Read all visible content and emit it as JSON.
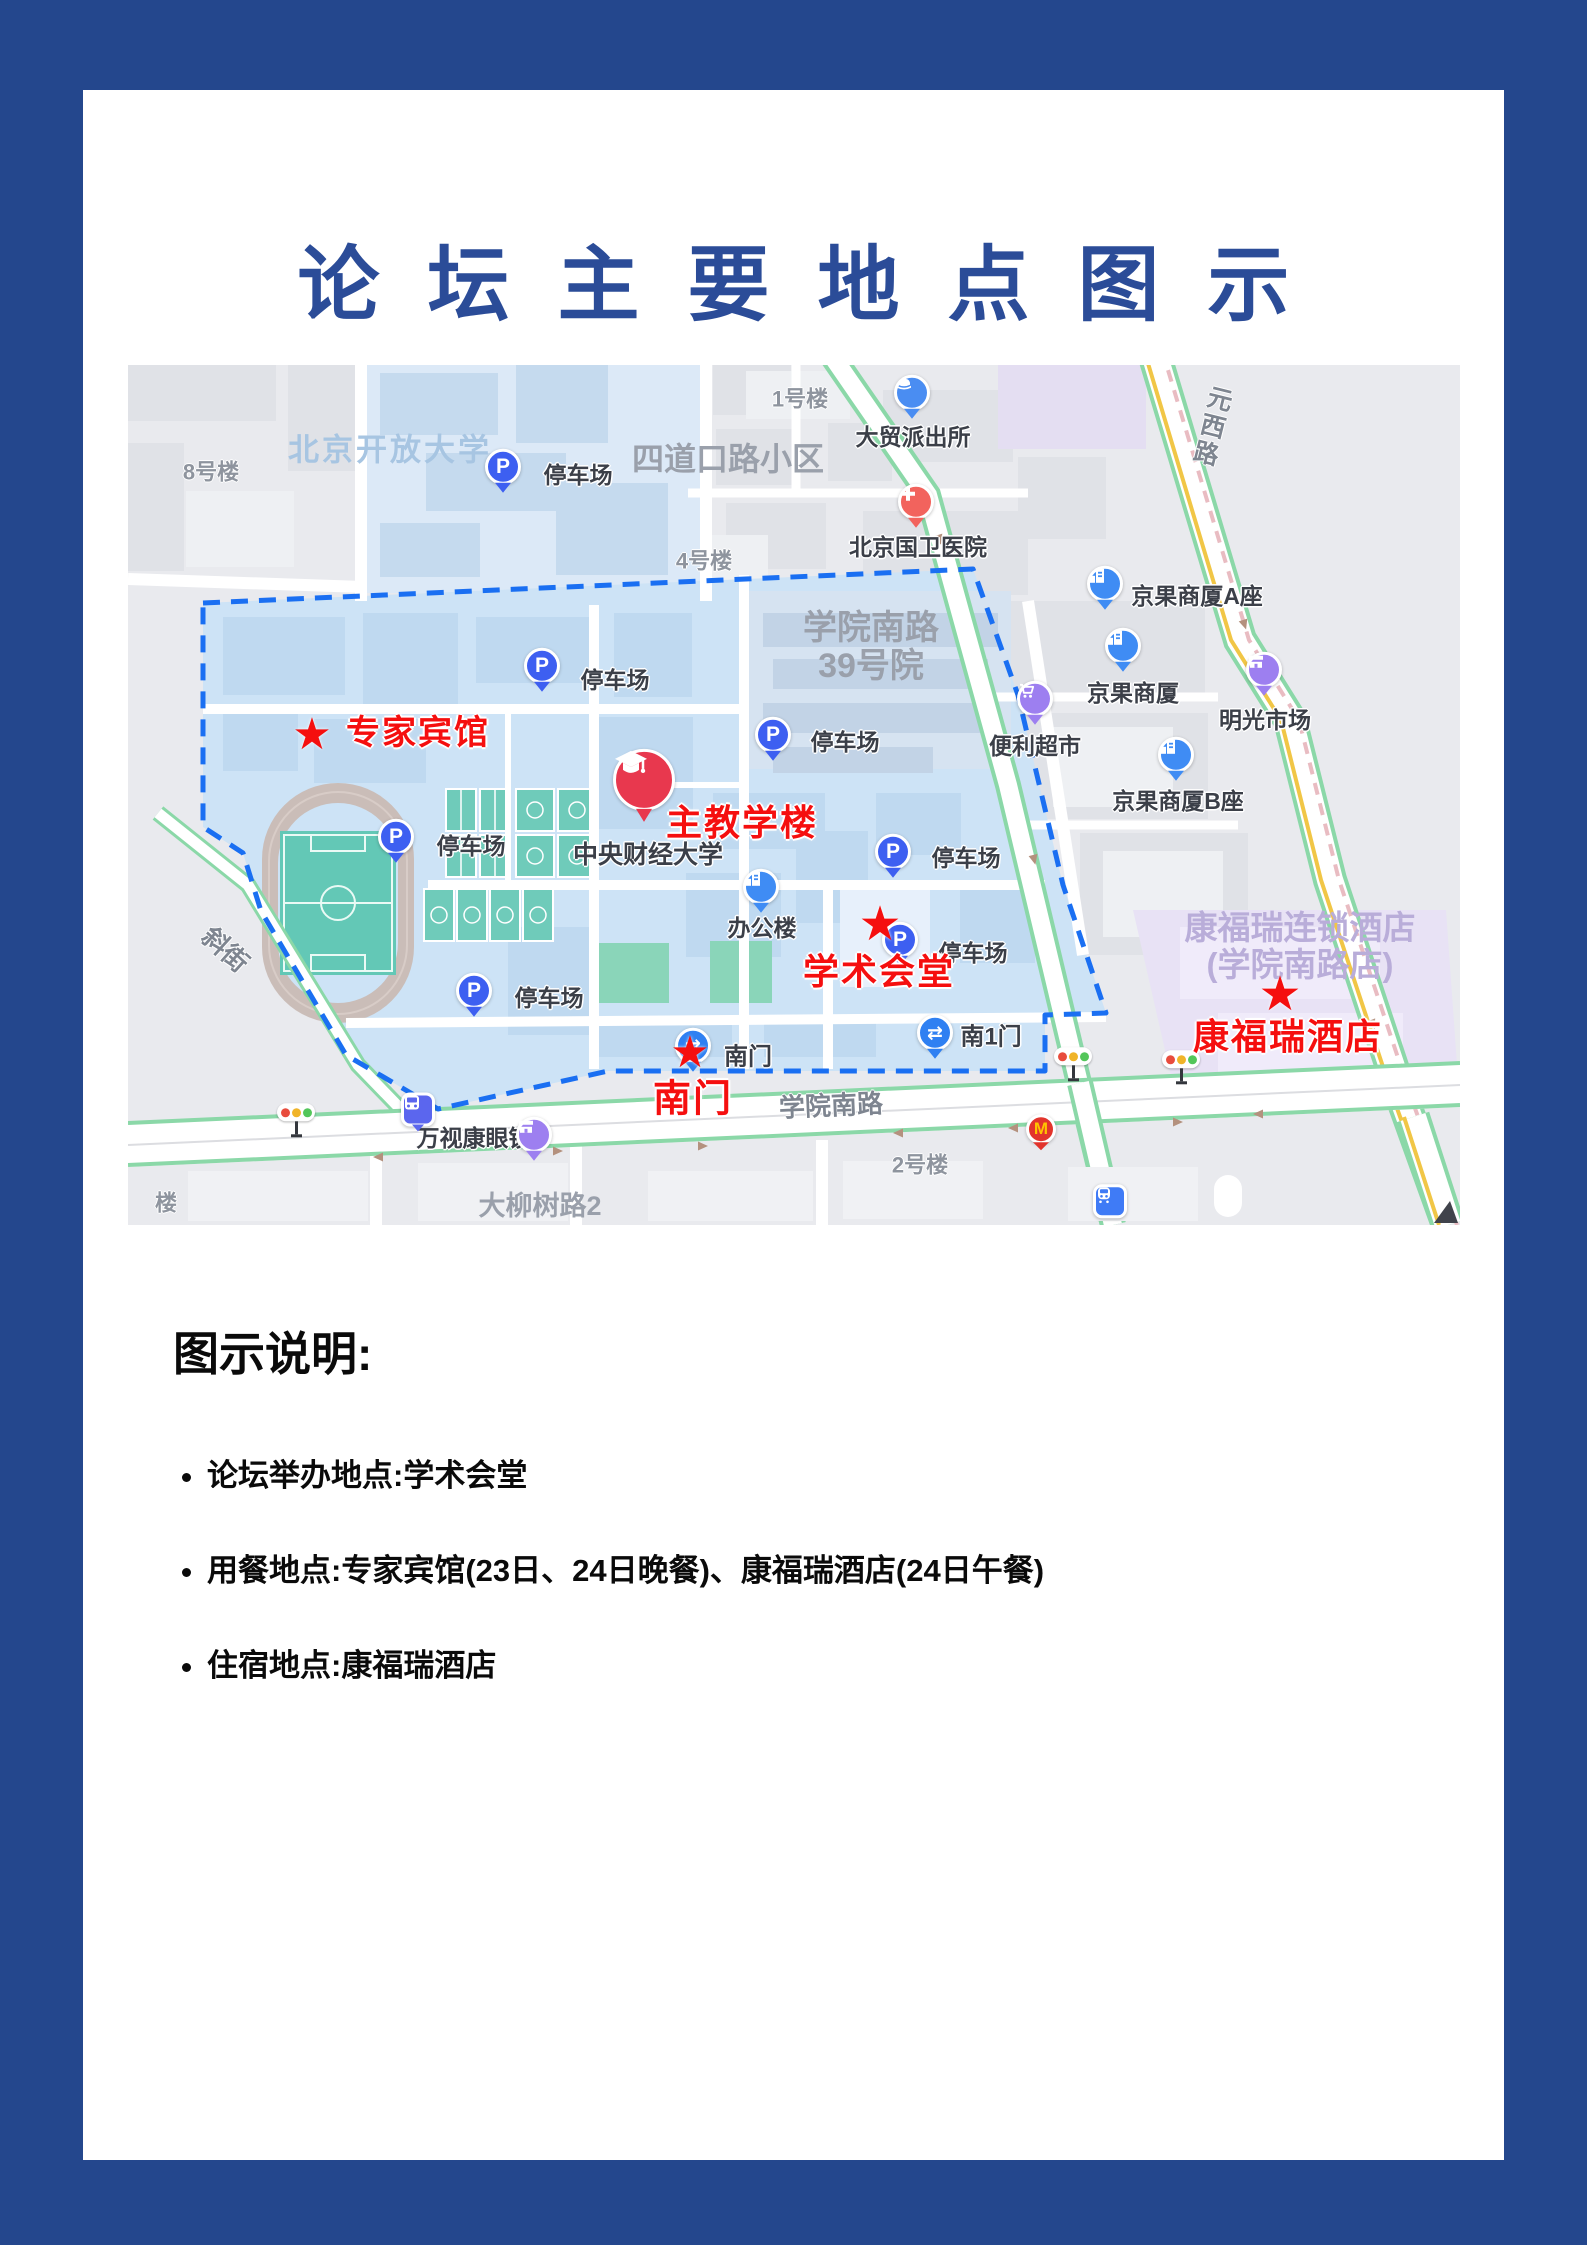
{
  "page": {
    "title": "论坛主要地点图示"
  },
  "colors": {
    "frame_blue": "#24478d",
    "title_blue": "#2b4c98",
    "highlight_red": "#f50f0f",
    "boundary_blue": "#1a6ff2",
    "campus_fill": "#cde3f6"
  },
  "legend": {
    "heading": "图示说明:",
    "items": [
      "论坛举办地点:学术会堂",
      "用餐地点:专家宾馆(23日、24日晚餐)、康福瑞酒店(24日午餐)",
      "住宿地点:康福瑞酒店"
    ]
  },
  "map": {
    "red_markers": [
      {
        "name": "marker-expert-hotel",
        "label": "专家宾馆",
        "star_x": 184,
        "star_y": 370,
        "label_x": 290,
        "label_y": 368,
        "star_size": 44,
        "font": 34
      },
      {
        "name": "marker-main-teaching-building",
        "label": "主教学楼",
        "label_x": 614,
        "label_y": 458,
        "font": 36
      },
      {
        "name": "marker-academic-hall",
        "label": "学术会堂",
        "star_x": 752,
        "star_y": 560,
        "label_x": 751,
        "label_y": 607,
        "star_size": 48,
        "font": 36
      },
      {
        "name": "marker-south-gate",
        "label": "南门",
        "star_x": 562,
        "star_y": 688,
        "label_x": 565,
        "label_y": 735,
        "star_size": 44,
        "font": 38
      },
      {
        "name": "marker-kangfurui-hotel",
        "label": "康福瑞酒店",
        "star_x": 1152,
        "star_y": 630,
        "label_x": 1160,
        "label_y": 672,
        "star_size": 48,
        "font": 36
      }
    ],
    "labels": [
      {
        "name": "label-beijing-open-university",
        "text": "北京开放大学",
        "x": 262,
        "y": 86,
        "cls": "areaBlue",
        "size": 31
      },
      {
        "name": "label-sidaokou-block",
        "text": "四道口路小区",
        "x": 600,
        "y": 95,
        "cls": "area",
        "size": 32
      },
      {
        "name": "label-building-8",
        "text": "8号楼",
        "x": 83,
        "y": 108,
        "cls": "bldg",
        "size": 22
      },
      {
        "name": "label-building-1",
        "text": "1号楼",
        "x": 672,
        "y": 35,
        "cls": "bldg",
        "size": 22
      },
      {
        "name": "label-building-4",
        "text": "4号楼",
        "x": 576,
        "y": 197,
        "cls": "bldg",
        "size": 22
      },
      {
        "name": "label-xueyuannanlu-39",
        "text": "学院南路\n39号院",
        "x": 743,
        "y": 282,
        "cls": "area",
        "size": 34
      },
      {
        "name": "label-damao-police-station",
        "text": "大贸派出所",
        "x": 785,
        "y": 73,
        "cls": "poi",
        "size": 23
      },
      {
        "name": "label-guowei-hospital",
        "text": "北京国卫医院",
        "x": 790,
        "y": 183,
        "cls": "poi",
        "size": 23
      },
      {
        "name": "label-jingguo-tower-a",
        "text": "京果商厦A座",
        "x": 1069,
        "y": 232,
        "cls": "poi",
        "size": 23
      },
      {
        "name": "label-jingguo-tower",
        "text": "京果商厦",
        "x": 1005,
        "y": 329,
        "cls": "poi",
        "size": 23
      },
      {
        "name": "label-mingguang-market",
        "text": "明光市场",
        "x": 1137,
        "y": 356,
        "cls": "poi",
        "size": 23
      },
      {
        "name": "label-convenience-store",
        "text": "便利超市",
        "x": 907,
        "y": 382,
        "cls": "poi",
        "size": 23
      },
      {
        "name": "label-jingguo-tower-b",
        "text": "京果商厦B座",
        "x": 1050,
        "y": 437,
        "cls": "poi",
        "size": 23
      },
      {
        "name": "label-cufe",
        "text": "中央财经大学",
        "x": 520,
        "y": 490,
        "cls": "poi",
        "size": 25
      },
      {
        "name": "label-office-building",
        "text": "办公楼",
        "x": 634,
        "y": 564,
        "cls": "poi",
        "size": 23
      },
      {
        "name": "label-wanshikang-optician",
        "text": "万视康眼镜",
        "x": 346,
        "y": 774,
        "cls": "poi",
        "size": 23
      },
      {
        "name": "label-south-gate-gray",
        "text": "南门",
        "x": 620,
        "y": 693,
        "cls": "poi",
        "size": 24
      },
      {
        "name": "label-south-gate-1",
        "text": "南1门",
        "x": 863,
        "y": 673,
        "cls": "poi",
        "size": 24
      },
      {
        "name": "label-parking-1",
        "text": "停车场",
        "x": 450,
        "y": 111,
        "cls": "poi",
        "size": 23
      },
      {
        "name": "label-parking-2",
        "text": "停车场",
        "x": 487,
        "y": 316,
        "cls": "poi",
        "size": 23
      },
      {
        "name": "label-parking-3",
        "text": "停车场",
        "x": 343,
        "y": 482,
        "cls": "poi",
        "size": 23
      },
      {
        "name": "label-parking-4",
        "text": "停车场",
        "x": 421,
        "y": 634,
        "cls": "poi",
        "size": 23
      },
      {
        "name": "label-parking-5",
        "text": "停车场",
        "x": 717,
        "y": 378,
        "cls": "poi",
        "size": 23
      },
      {
        "name": "label-parking-6",
        "text": "停车场",
        "x": 838,
        "y": 494,
        "cls": "poi",
        "size": 23
      },
      {
        "name": "label-parking-7",
        "text": "停车场",
        "x": 845,
        "y": 589,
        "cls": "poi",
        "size": 23
      },
      {
        "name": "label-xueyuan-south-road",
        "text": "学院南路",
        "x": 703,
        "y": 741,
        "cls": "road",
        "size": 26,
        "rot": -2.5
      },
      {
        "name": "label-daliushu-road",
        "text": "大柳树路2",
        "x": 412,
        "y": 841,
        "cls": "area",
        "size": 27
      },
      {
        "name": "label-lou-partial",
        "text": "楼",
        "x": 38,
        "y": 839,
        "cls": "bldg",
        "size": 22
      },
      {
        "name": "label-yuanxi-road",
        "text": "元\n西\n路",
        "x": 1085,
        "y": 62,
        "cls": "road",
        "size": 25,
        "rot": 14
      },
      {
        "name": "label-xiejie-road",
        "text": "斜街",
        "x": 97,
        "y": 585,
        "cls": "road",
        "size": 26,
        "rot": 42
      },
      {
        "name": "label-kangfurui-chain-hotel",
        "text": "康福瑞连锁酒店\n(学院南路店)",
        "x": 1172,
        "y": 582,
        "cls": "areaPurple",
        "size": 33
      },
      {
        "name": "label-building-2",
        "text": "2号楼",
        "x": 792,
        "y": 801,
        "cls": "bldg",
        "size": 22
      }
    ],
    "icons": [
      {
        "name": "parking-pin-icon",
        "type": "parking",
        "x": 375,
        "y": 108
      },
      {
        "name": "parking-pin-icon",
        "type": "parking",
        "x": 414,
        "y": 307
      },
      {
        "name": "parking-pin-icon",
        "type": "parking",
        "x": 268,
        "y": 478
      },
      {
        "name": "parking-pin-icon",
        "type": "parking",
        "x": 346,
        "y": 632
      },
      {
        "name": "parking-pin-icon",
        "type": "parking",
        "x": 645,
        "y": 376
      },
      {
        "name": "parking-pin-icon",
        "type": "parking",
        "x": 765,
        "y": 493
      },
      {
        "name": "parking-pin-icon",
        "type": "parking",
        "x": 772,
        "y": 581
      },
      {
        "name": "police-station-icon",
        "type": "police",
        "x": 784,
        "y": 34
      },
      {
        "name": "hospital-icon",
        "type": "hospital",
        "x": 788,
        "y": 143
      },
      {
        "name": "building-icon",
        "type": "building",
        "x": 977,
        "y": 225
      },
      {
        "name": "building-icon",
        "type": "building",
        "x": 995,
        "y": 287
      },
      {
        "name": "building-icon",
        "type": "building",
        "x": 1048,
        "y": 396
      },
      {
        "name": "office-building-icon",
        "type": "building",
        "x": 633,
        "y": 528
      },
      {
        "name": "market-icon",
        "type": "shop",
        "x": 1136,
        "y": 311
      },
      {
        "name": "optician-shop-icon",
        "type": "shop",
        "x": 406,
        "y": 776
      },
      {
        "name": "supermarket-cart-icon",
        "type": "cart",
        "x": 907,
        "y": 340
      },
      {
        "name": "south-gate-icon",
        "type": "gate",
        "x": 565,
        "y": 687
      },
      {
        "name": "south-gate-1-icon",
        "type": "gate",
        "x": 807,
        "y": 674
      },
      {
        "name": "university-grad-cap-icon",
        "type": "grad",
        "x": 516,
        "y": 424
      },
      {
        "name": "bus-stop-icon",
        "type": "bus",
        "x": 290,
        "y": 749
      },
      {
        "name": "metro-station-icon",
        "type": "metro",
        "x": 982,
        "y": 838
      },
      {
        "name": "traffic-light-icon",
        "type": "traffic",
        "x": 168,
        "y": 757
      },
      {
        "name": "traffic-light-icon",
        "type": "traffic",
        "x": 945,
        "y": 701
      },
      {
        "name": "traffic-light-icon",
        "type": "traffic",
        "x": 1053,
        "y": 704
      },
      {
        "name": "mcdonalds-icon",
        "type": "mcd",
        "x": 913,
        "y": 769
      }
    ]
  }
}
